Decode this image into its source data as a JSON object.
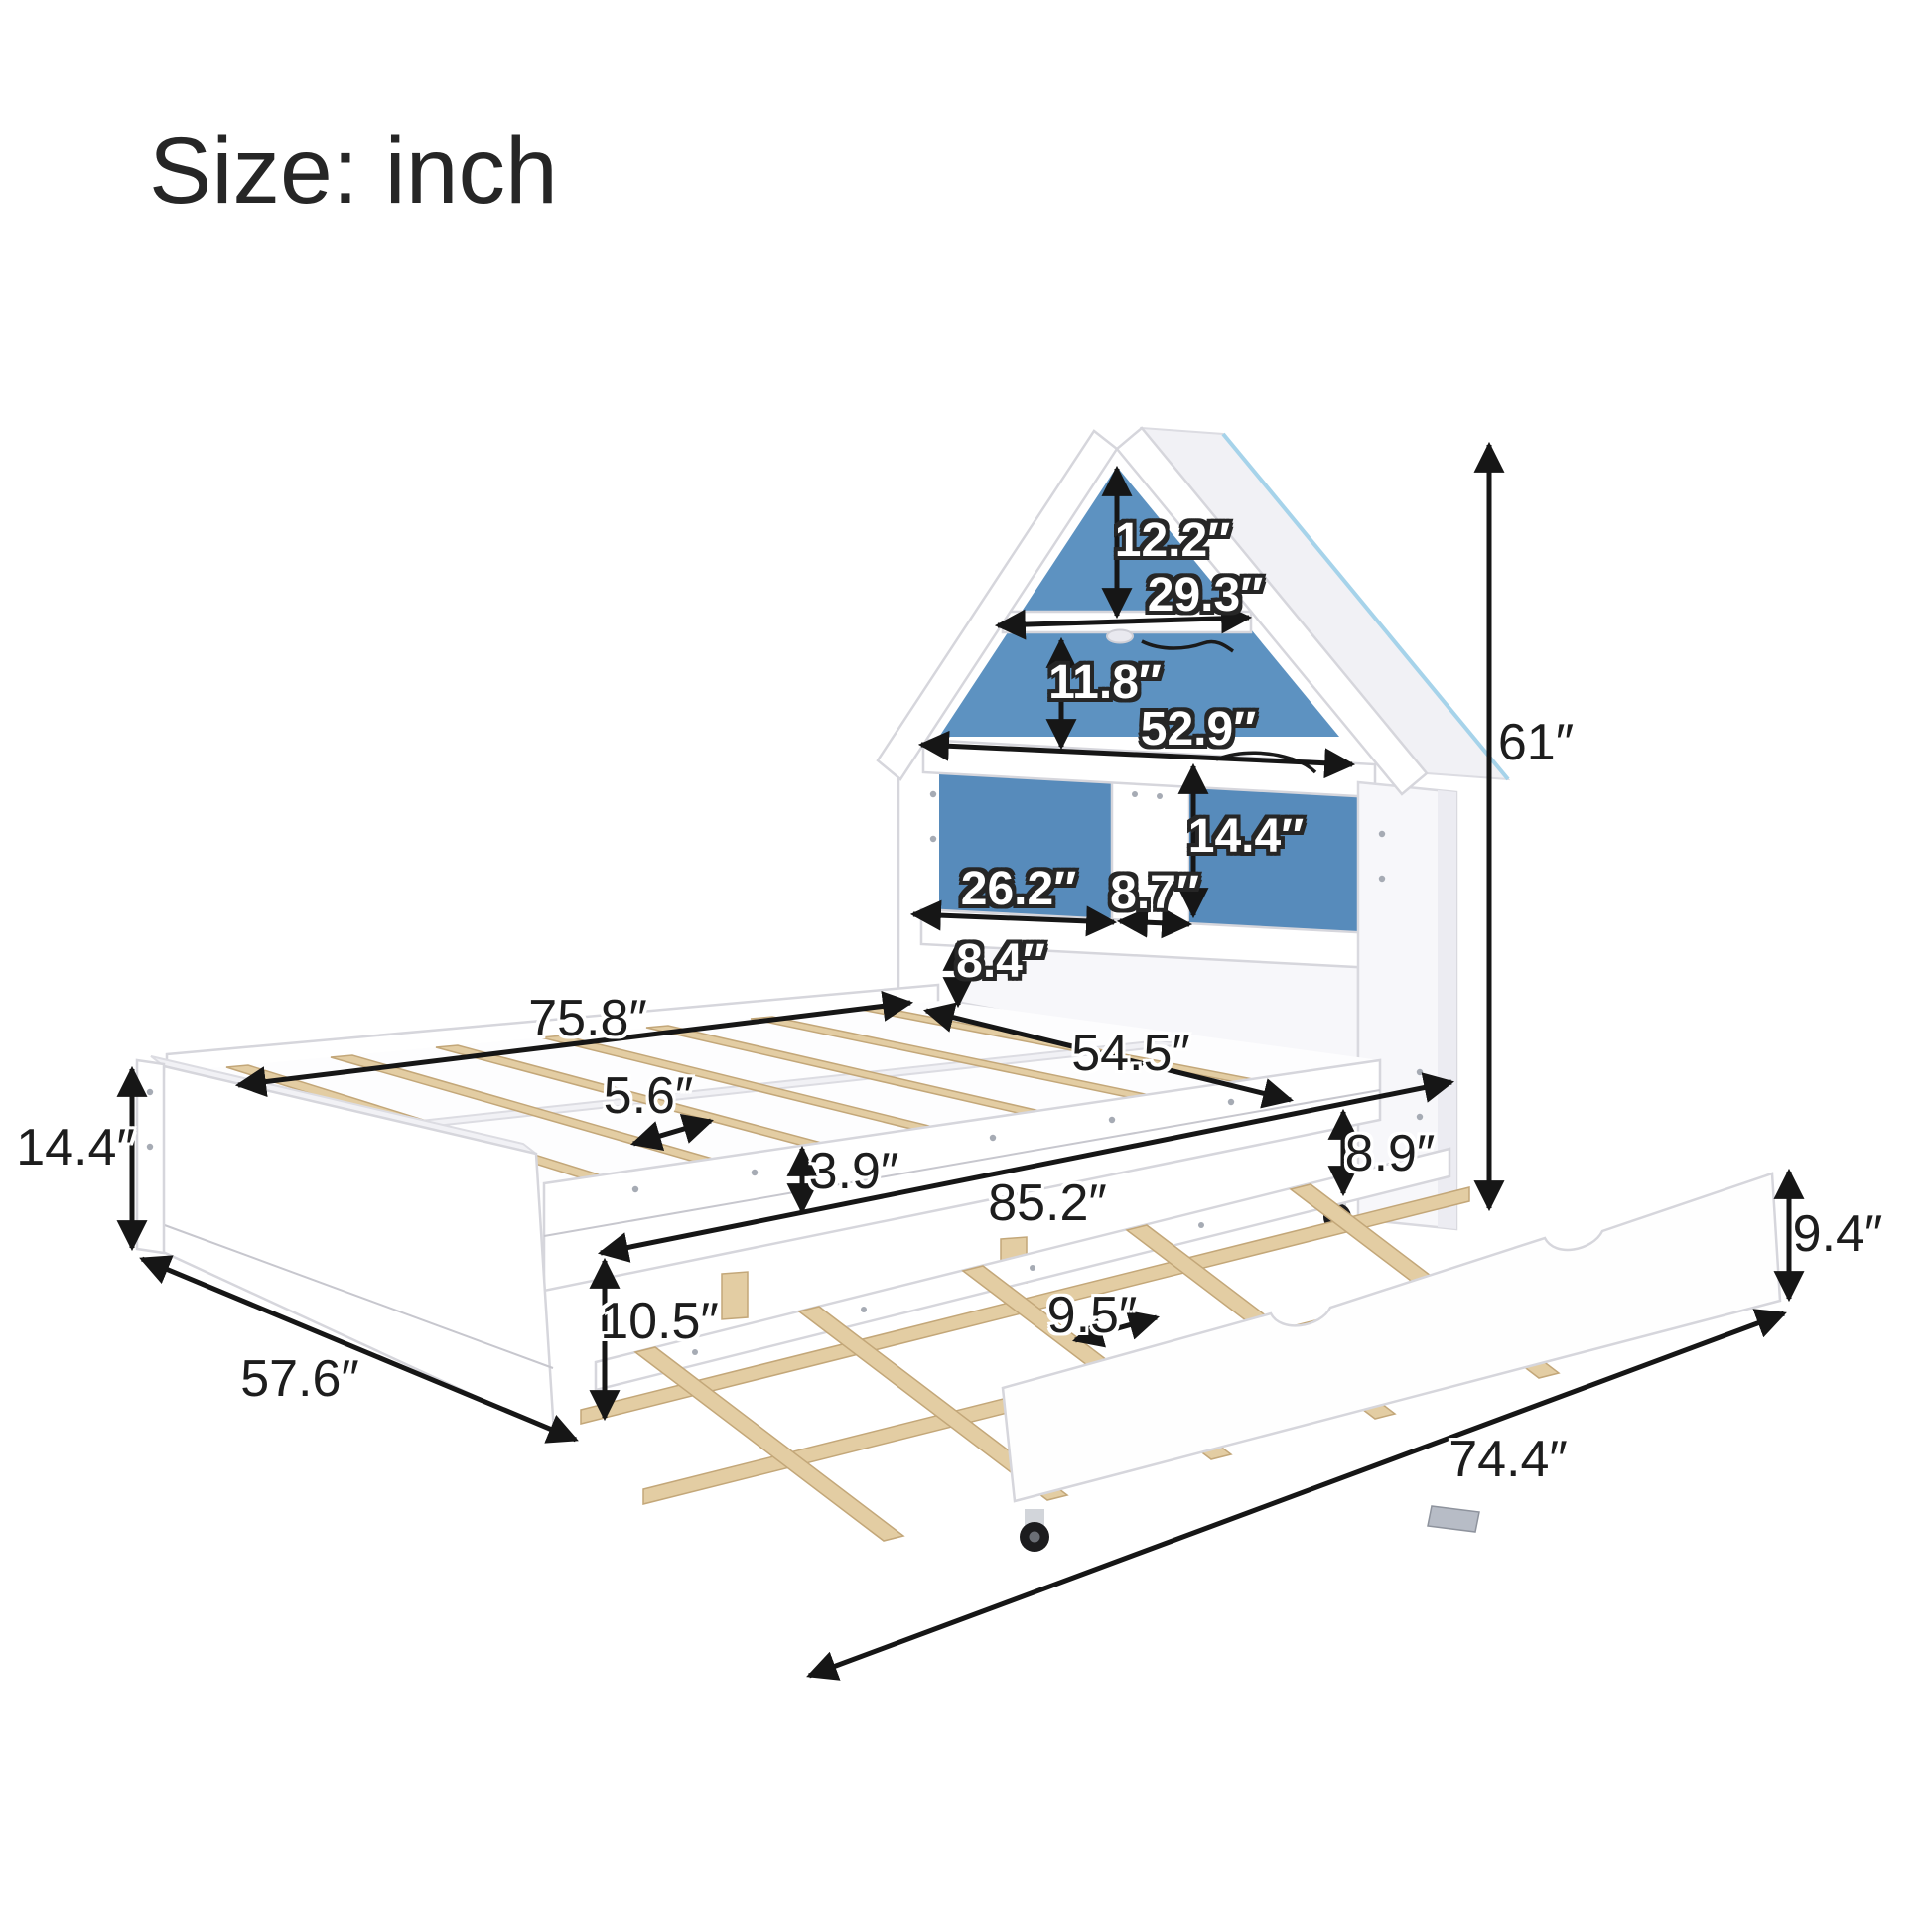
{
  "title": "Size: inch",
  "labels": {
    "roof_peak_height": "12.2″",
    "gable_shelf_width": "29.3″",
    "middle_section_height": "11.8″",
    "eave_shelf_width": "52.9″",
    "cubby_height": "14.4″",
    "left_cubby_width": "26.2″",
    "divider_width": "8.7″",
    "shelf_to_bed_height": "8.4″",
    "bed_length": "75.8″",
    "bed_width": "54.5″",
    "slat_spacing": "5.6″",
    "rail_height": "3.9″",
    "total_length": "85.2″",
    "under_bed_clearance": "8.9″",
    "frame_height": "14.4″",
    "frame_depth": "57.6″",
    "trundle_clearance": "10.5″",
    "trundle_slat_spacing": "9.5″",
    "trundle_height": "9.4″",
    "trundle_length": "74.4″",
    "overall_height": "61″"
  },
  "colors": {
    "blue_panel": "#5d92c1",
    "blue_panel_deep": "#578bbb",
    "roof_edge_blue": "#a6d3ea",
    "wood": "#e3cda3",
    "wood_dark": "#c3a779",
    "arrow": "#161616"
  }
}
